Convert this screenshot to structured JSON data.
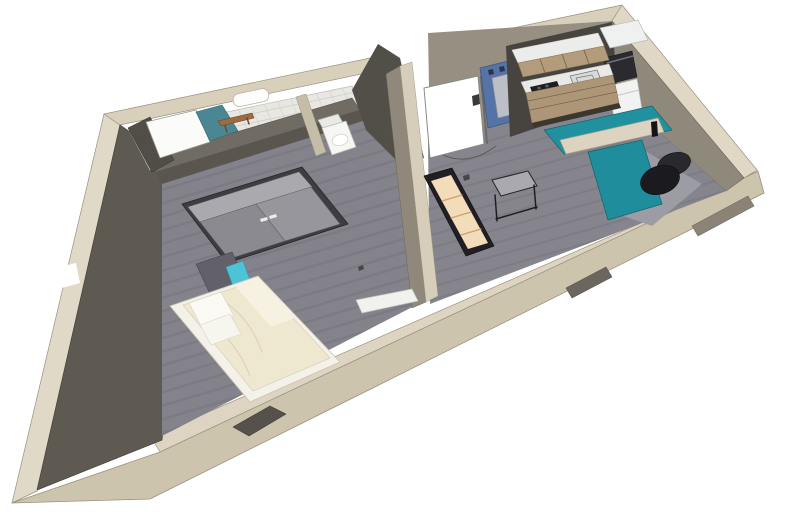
{
  "meta": {
    "description": "3D cutaway render of a studio apartment floor plan",
    "image_type": "3d-floorplan-render",
    "background": "#FFFFFF"
  },
  "palette": {
    "shell_light": "#DDD5C2",
    "shell_face": "#CDC4AD",
    "wall_dark": "#5E5951",
    "wall_taupe": "#8F897B",
    "floor_wood": "#84838B",
    "tile_white": "#E8E7E2",
    "accent_teal_desk": "#21919F",
    "accent_teal_shower": "#4B8793",
    "accent_cyan_drawer": "#4EC3D8",
    "accent_blue_panel": "#5673A7",
    "cabinet_tan": "#B39C7B",
    "bed_cream": "#EFE8D1"
  },
  "rooms": [
    {
      "name": "bathroom",
      "items": [
        "shower",
        "glass-panel",
        "towel-radiator",
        "wood-bench"
      ]
    },
    {
      "name": "wc",
      "items": [
        "toilet"
      ]
    },
    {
      "name": "bedroom",
      "items": [
        "wardrobe",
        "bed",
        "nightstand",
        "wall-radiator"
      ]
    },
    {
      "name": "entry-hall",
      "items": [
        "entrance-door",
        "blue-coat-panel-with-mirror",
        "light-switch"
      ]
    },
    {
      "name": "kitchen",
      "items": [
        "upper-cabinets",
        "counter",
        "cooktop",
        "sink",
        "lower-cabinets",
        "oven",
        "fridge"
      ]
    },
    {
      "name": "living-area",
      "items": [
        "l-shaped-desk",
        "desk-divider",
        "office-chair",
        "bookcase",
        "side-table"
      ]
    }
  ],
  "scene": {
    "width": 800,
    "height": 524,
    "shapes": [
      {
        "t": "p",
        "n": "south-wall-outer-face",
        "pts": "758,171 764,193 150,499 12,503 160,452",
        "f": "#CDC4AD",
        "s": "#9A9280",
        "w": 0.8
      },
      {
        "t": "p",
        "n": "south-wall-top-band",
        "pts": "758,171 744,178 151,437 160,452",
        "f": "#DDD5C2",
        "s": "#9A9280",
        "w": 0.7
      },
      {
        "t": "p",
        "n": "west-wall-top-strip",
        "pts": "104,114 120,125 37,491 12,503",
        "f": "#E1D9C7",
        "s": "#9A9280",
        "w": 0.7
      },
      {
        "t": "p",
        "n": "west-wall-window-notch",
        "pts": "55,268 76,263 80,283 58,289",
        "f": "#FFFFFF"
      },
      {
        "t": "p",
        "n": "north-wall-top-band",
        "pts": "104,114 622,5 612,21 120,125",
        "f": "#D8D0BB",
        "s": "#9A9280",
        "w": 0.7
      },
      {
        "t": "p",
        "n": "east-wall-top-band",
        "pts": "622,5 757,170 744,178 612,21",
        "f": "#E0D8C5",
        "s": "#9A9280",
        "w": 0.7
      },
      {
        "t": "p",
        "n": "entrance-door-opening",
        "pts": "374,41 434,29 440,58 382,71",
        "f": "#FFFFFF"
      },
      {
        "t": "p",
        "n": "west-wall-interior-face",
        "pts": "120,125 196,178 162,440 37,490",
        "f": "#5E5951",
        "s": "#474339",
        "w": 0.7
      },
      {
        "t": "p",
        "n": "east-wall-interior-face",
        "pts": "612,21 744,178 726,191 618,96",
        "f": "#8F897B",
        "s": "#6E685C",
        "w": 0.6
      },
      {
        "t": "p",
        "n": "north-wall-interior-hall",
        "pts": "428,33 612,21 618,96 430,140",
        "f": "#968F82"
      },
      {
        "t": "p",
        "n": "bathroom-tile-floor",
        "pts": "130,132 352,86 374,146 150,170",
        "f": "#E8E7E2",
        "s": "#BBBAB4",
        "w": 0.7
      },
      {
        "t": "h",
        "n": "tile-grout-horizontal",
        "clip": "130,132 352,86 374,146 150,170",
        "x1": 126,
        "y1": 131,
        "x2": 380,
        "y2": 78,
        "dx": 0,
        "dy": 9,
        "cnt": 7,
        "s": "#CFCEC8",
        "w": 0.8
      },
      {
        "t": "h",
        "n": "tile-grout-vertical",
        "clip": "130,132 352,86 374,146 150,170",
        "x1": 134,
        "y1": 130,
        "x2": 156,
        "y2": 182,
        "dx": 13,
        "dy": -2.7,
        "cnt": 18,
        "s": "#D3D2CC",
        "w": 0.7
      },
      {
        "t": "p",
        "n": "bedroom-floor",
        "pts": "162,180 360,118 404,104 426,300 162,436",
        "f": "#84838B"
      },
      {
        "t": "h",
        "n": "bedroom-floor-planks",
        "clip": "162,180 360,118 404,104 426,300 162,436",
        "x1": 150,
        "y1": 180,
        "x2": 430,
        "y2": 96,
        "dx": 0,
        "dy": 13.5,
        "cnt": 20,
        "s": "#73727A",
        "w": 2.4,
        "o": 0.5
      },
      {
        "t": "p",
        "n": "living-floor",
        "pts": "428,140 618,96 726,191 430,304",
        "f": "#86858D"
      },
      {
        "t": "h",
        "n": "living-floor-planks",
        "clip": "428,140 618,96 726,191 430,304",
        "x1": 420,
        "y1": 160,
        "x2": 740,
        "y2": 70,
        "dx": 0,
        "dy": 13,
        "cnt": 19,
        "s": "#75747C",
        "w": 2.2,
        "o": 0.5
      },
      {
        "t": "p",
        "n": "living-floor-light-patch",
        "pts": "606,210 640,148 702,184 652,226",
        "f": "#9B9CA4"
      },
      {
        "t": "p",
        "n": "window-slot-right",
        "pts": "692,226 748,196 754,206 698,236",
        "f": "#8A8376",
        "s": "#6E6A5E",
        "w": 0.6
      },
      {
        "t": "p",
        "n": "window-slot-middle",
        "pts": "566,288 606,267 612,277 572,298",
        "f": "#6B675F",
        "s": "#56534B",
        "w": 0.6
      },
      {
        "t": "p",
        "n": "window-slot-bedroom",
        "pts": "233,427 270,406 286,414 249,436",
        "f": "#56524B",
        "s": "#403D36",
        "w": 0.6
      },
      {
        "t": "p",
        "n": "bath-partition-top",
        "pts": "148,158 352,98 360,110 156,172",
        "f": "#706C63",
        "s": "#54504A",
        "w": 0.6
      },
      {
        "t": "p",
        "n": "bath-partition-face",
        "pts": "156,172 360,110 366,120 162,184",
        "f": "#5A564F"
      },
      {
        "t": "p",
        "n": "wc-divider-wall",
        "pts": "296,97 306,94 326,152 316,156",
        "f": "#C6BDA8",
        "s": "#9A9280",
        "w": 0.5
      },
      {
        "t": "p",
        "n": "wc-east-wall",
        "pts": "352,90 378,44 400,58 424,158 402,166 366,130",
        "f": "#524E48"
      },
      {
        "t": "p",
        "n": "hall-partition-west-face",
        "pts": "386,74 400,66 426,302 412,308",
        "f": "#8F887B",
        "s": "#6E685C",
        "w": 0.5
      },
      {
        "t": "p",
        "n": "hall-partition-top",
        "pts": "400,66 412,62 438,296 426,302",
        "f": "#D6CEBA",
        "s": "#A49B84",
        "w": 0.5
      },
      {
        "t": "p",
        "n": "shower-wall",
        "pts": "128,128 150,117 174,160 152,172",
        "f": "#514D47",
        "s": "#3C3934",
        "w": 0.6
      },
      {
        "t": "p",
        "n": "shower-glass-panel",
        "pts": "146,122 196,110 210,142 160,158",
        "f": "#FBFBF9",
        "s": "#9A9A94",
        "w": 0.8
      },
      {
        "t": "p",
        "n": "shower-teal-floor",
        "pts": "196,112 222,105 238,131 210,141",
        "f": "#4B8793",
        "s": "#35646E",
        "w": 0.6
      },
      {
        "t": "r",
        "n": "towel-radiator",
        "x": 0,
        "y": 0,
        "wd": 36,
        "ht": 13,
        "rx": 6,
        "f": "#FDFDFC",
        "s": "#B5B4AE",
        "w": 0.8,
        "tr": "translate(232,95) rotate(-12)"
      },
      {
        "t": "p",
        "n": "wood-bench",
        "pts": "218,121 252,113 254,118 221,126",
        "f": "#9C6B3F",
        "s": "#6B4426",
        "w": 0.6
      },
      {
        "t": "l",
        "n": "bench-leg-left",
        "x1": 225,
        "y1": 126,
        "x2": 227,
        "y2": 132,
        "s": "#6B4426",
        "w": 1.4
      },
      {
        "t": "l",
        "n": "bench-leg-right",
        "x1": 247,
        "y1": 118,
        "x2": 249,
        "y2": 124,
        "s": "#6B4426",
        "w": 1.4
      },
      {
        "t": "p",
        "n": "toilet-tank",
        "pts": "318,120 338,114 346,128 326,134",
        "f": "#E9E9E5",
        "s": "#B0B0AA",
        "w": 0.7
      },
      {
        "t": "p",
        "n": "toilet-body",
        "pts": "322,128 346,121 356,147 332,155",
        "f": "#F6F6F3",
        "s": "#B9B8B2",
        "w": 0.8
      },
      {
        "t": "e",
        "n": "toilet-seat",
        "cx": 340,
        "cy": 140,
        "rx": 8,
        "ry": 5.5,
        "f": "#FFFFFF",
        "s": "#CCCCC6",
        "w": 0.7,
        "tr": "rotate(-14 340 140)"
      },
      {
        "t": "p",
        "n": "wardrobe-frame",
        "pts": "182,204 302,167 348,224 227,263",
        "f": "#3E3D42",
        "s": "#26252A",
        "w": 0.8
      },
      {
        "t": "p",
        "n": "wardrobe-top-face",
        "pts": "188,207 299,172 312,187 200,222",
        "f": "#A9A9AE",
        "s": "#7F7F85",
        "w": 0.5
      },
      {
        "t": "p",
        "n": "wardrobe-door-left",
        "pts": "200,222 256,204 285,241 229,259",
        "f": "#8A8A90",
        "s": "#5C5C62",
        "w": 0.6
      },
      {
        "t": "p",
        "n": "wardrobe-door-right",
        "pts": "256,204 311,187 340,224 285,241",
        "f": "#96969C",
        "s": "#5C5C62",
        "w": 0.6
      },
      {
        "t": "p",
        "n": "wardrobe-handle-left",
        "pts": "260,219 267,217 268,220 261,222",
        "f": "#ECECEA"
      },
      {
        "t": "p",
        "n": "wardrobe-handle-right",
        "pts": "269,216 276,214 277,217 270,219",
        "f": "#ECECEA"
      },
      {
        "t": "p",
        "n": "nightstand-body",
        "pts": "196,264 232,252 246,282 210,294",
        "f": "#62616A",
        "s": "#47464E",
        "w": 0.6
      },
      {
        "t": "p",
        "n": "nightstand-cyan-drawer",
        "pts": "226,267 243,261 251,283 234,289",
        "f": "#4EC3D8",
        "s": "#2E97AB",
        "w": 0.6
      },
      {
        "t": "p",
        "n": "bed-frame",
        "pts": "170,306 258,276 340,362 250,402",
        "f": "#F3F1E8",
        "s": "#C9C6B8",
        "w": 0.9
      },
      {
        "t": "p",
        "n": "bed-duvet",
        "pts": "183,305 258,280 330,358 253,391",
        "f": "#EFE8D1",
        "s": "#D8D0B4",
        "w": 0.7
      },
      {
        "t": "p",
        "n": "duvet-fold",
        "pts": "236,287 259,279 294,318 271,327",
        "f": "#F6F1E0"
      },
      {
        "t": "d",
        "n": "duvet-crease-1",
        "d": "M222,300 Q250,318 262,352",
        "f": "none",
        "s": "#DCD4BA",
        "w": 1.2
      },
      {
        "t": "d",
        "n": "duvet-crease-2",
        "d": "M206,320 Q236,340 250,376",
        "f": "none",
        "s": "#DCD4BA",
        "w": 1.2
      },
      {
        "t": "p",
        "n": "pillow-1",
        "pts": "189,303 221,292 234,316 202,328",
        "f": "#FAF9F4",
        "s": "#D8D5C8",
        "w": 0.7
      },
      {
        "t": "p",
        "n": "pillow-2",
        "pts": "200,325 230,314 241,334 211,345",
        "f": "#F6F5EE",
        "s": "#D8D5C8",
        "w": 0.6
      },
      {
        "t": "p",
        "n": "bedroom-wall-radiator",
        "pts": "356,300 412,289 418,301 362,313",
        "f": "#F1F1ED",
        "s": "#C2C2BC",
        "w": 0.7
      },
      {
        "t": "d",
        "n": "door-swing-arc",
        "d": "M 434,150 Q 464,170 496,146",
        "f": "none",
        "s": "#5A5A5A",
        "w": 1
      },
      {
        "t": "p",
        "n": "entrance-door-leaf",
        "pts": "424,88 478,76 484,144 430,158",
        "f": "#FFFFFF",
        "s": "#8A8A86",
        "w": 1
      },
      {
        "t": "l",
        "n": "entrance-door-edge",
        "x1": 481,
        "y1": 77,
        "x2": 487,
        "y2": 143,
        "s": "#6A6A66",
        "w": 2
      },
      {
        "t": "p",
        "n": "blue-coat-panel",
        "pts": "480,68 524,57 532,116 488,128",
        "f": "#5673A7",
        "s": "#3D5680",
        "w": 0.8
      },
      {
        "t": "p",
        "n": "coat-panel-mirror",
        "pts": "492,78 512,73 518,113 498,118",
        "f": "#BCC0C6",
        "s": "#8B8F96",
        "w": 0.7
      },
      {
        "t": "p",
        "n": "coat-hook-1",
        "pts": "488,70 493,69 494,74 489,75",
        "f": "#2A3642"
      },
      {
        "t": "p",
        "n": "coat-hook-2",
        "pts": "499,67 504,66 505,71 500,72",
        "f": "#2A3642"
      },
      {
        "t": "p",
        "n": "coat-hook-3",
        "pts": "510,64 515,63 516,68 511,69",
        "f": "#2A3642"
      },
      {
        "t": "p",
        "n": "light-switch",
        "pts": "472,96 479,94 480,104 473,106",
        "f": "#3A3A3E"
      },
      {
        "t": "p",
        "n": "kitchen-backsplash",
        "pts": "506,46 612,22 618,100 510,137",
        "f": "#474440"
      },
      {
        "t": "p",
        "n": "tall-unit-top",
        "pts": "600,28 638,20 648,40 610,48",
        "f": "#EFF1F0",
        "s": "#B9BCBA",
        "w": 0.7
      },
      {
        "t": "p",
        "n": "oven",
        "pts": "604,58 632,51 637,77 609,84",
        "f": "#2B2B2F",
        "s": "#151518",
        "w": 0.6
      },
      {
        "t": "l",
        "n": "oven-handle",
        "x1": 607,
        "y1": 63,
        "x2": 633,
        "y2": 56,
        "s": "#70707A",
        "w": 1.5
      },
      {
        "t": "p",
        "n": "fridge",
        "pts": "609,86 637,79 642,110 614,118",
        "f": "#F1F2F1",
        "s": "#C5C8C6",
        "w": 0.7
      },
      {
        "t": "l",
        "n": "fridge-seam",
        "x1": 611,
        "y1": 97,
        "x2": 639,
        "y2": 90,
        "s": "#C5C8C6",
        "w": 1
      },
      {
        "t": "p",
        "n": "upper-cabinets-top",
        "pts": "512,50 598,33 604,46 518,63",
        "f": "#ECEDEA",
        "s": "#C5C6C2",
        "w": 0.6
      },
      {
        "t": "p",
        "n": "upper-cabinets-front",
        "pts": "518,63 604,46 609,60 523,77",
        "f": "#B39C7B",
        "s": "#8A7455",
        "w": 0.6
      },
      {
        "t": "l",
        "n": "upper-cabinet-seam-1",
        "x1": 540,
        "y1": 59,
        "x2": 545,
        "y2": 73,
        "s": "#7A6548",
        "w": 0.9
      },
      {
        "t": "l",
        "n": "upper-cabinet-seam-2",
        "x1": 562,
        "y1": 54,
        "x2": 567,
        "y2": 68,
        "s": "#7A6548",
        "w": 0.9
      },
      {
        "t": "l",
        "n": "upper-cabinet-seam-3",
        "x1": 584,
        "y1": 50,
        "x2": 589,
        "y2": 64,
        "s": "#7A6548",
        "w": 0.9
      },
      {
        "t": "p",
        "n": "kitchen-counter",
        "pts": "521,82 609,64 613,75 526,93",
        "f": "#E9EAE7",
        "s": "#B9BAB6",
        "w": 0.6
      },
      {
        "t": "p",
        "n": "cooktop",
        "pts": "530,87 557,81 561,91 534,97",
        "f": "#1E1E22"
      },
      {
        "t": "e",
        "n": "burner-1",
        "cx": 539,
        "cy": 88,
        "rx": 2,
        "ry": 1.5,
        "f": "#55555B"
      },
      {
        "t": "e",
        "n": "burner-2",
        "cx": 547,
        "cy": 86,
        "rx": 2,
        "ry": 1.5,
        "f": "#55555B"
      },
      {
        "t": "e",
        "n": "burner-3",
        "cx": 543,
        "cy": 93,
        "rx": 2,
        "ry": 1.5,
        "f": "#55555B"
      },
      {
        "t": "e",
        "n": "burner-4",
        "cx": 551,
        "cy": 91,
        "rx": 2,
        "ry": 1.5,
        "f": "#55555B"
      },
      {
        "t": "p",
        "n": "kitchen-sink",
        "pts": "570,76 597,70 601,80 574,86",
        "f": "#D8DAD9",
        "s": "#75777A",
        "w": 0.8
      },
      {
        "t": "p",
        "n": "sink-basin",
        "pts": "576,78 592,75 595,81 579,84",
        "f": "none",
        "s": "#75777A",
        "w": 0.7
      },
      {
        "t": "p",
        "n": "lower-cabinets-front",
        "pts": "526,93 613,75 619,103 532,123",
        "f": "#AD9678",
        "s": "#8A7455",
        "w": 0.6
      },
      {
        "t": "l",
        "n": "drawer-seam-1",
        "x1": 528,
        "y1": 101,
        "x2": 615,
        "y2": 83,
        "s": "#7A6548",
        "w": 0.8
      },
      {
        "t": "l",
        "n": "drawer-seam-2",
        "x1": 530,
        "y1": 110,
        "x2": 617,
        "y2": 92,
        "s": "#7A6548",
        "w": 0.8
      },
      {
        "t": "p",
        "n": "cabinet-kickboard",
        "pts": "532,123 619,103 621,108 534,128",
        "f": "#3B362E"
      },
      {
        "t": "p",
        "n": "bookcase-frame",
        "pts": "424,176 452,168 494,246 466,256",
        "f": "#211F24",
        "s": "#121015",
        "w": 0.7
      },
      {
        "t": "p",
        "n": "bookcase-front",
        "pts": "431,181 451,175 488,243 468,249",
        "f": "#F2DCBA"
      },
      {
        "t": "l",
        "n": "bookcase-shelf-1",
        "x1": 442,
        "y1": 201,
        "x2": 462,
        "y2": 195,
        "s": "#C9A26E",
        "w": 1.2
      },
      {
        "t": "l",
        "n": "bookcase-shelf-2",
        "x1": 451,
        "y1": 218,
        "x2": 471,
        "y2": 212,
        "s": "#C9A26E",
        "w": 1.2
      },
      {
        "t": "l",
        "n": "bookcase-shelf-3",
        "x1": 461,
        "y1": 235,
        "x2": 481,
        "y2": 229,
        "s": "#C9A26E",
        "w": 1.2
      },
      {
        "t": "p",
        "n": "side-table-top",
        "pts": "492,180 528,171 537,186 501,196",
        "f": "#A9A9AF",
        "s": "#2A2A2E",
        "w": 1.1
      },
      {
        "t": "l",
        "n": "side-table-leg-1",
        "x1": 495,
        "y1": 195,
        "x2": 497,
        "y2": 221,
        "s": "#1E1E22",
        "w": 1.5
      },
      {
        "t": "l",
        "n": "side-table-leg-2",
        "x1": 534,
        "y1": 185,
        "x2": 536,
        "y2": 209,
        "s": "#1E1E22",
        "w": 1.5
      },
      {
        "t": "l",
        "n": "side-table-shelf",
        "x1": 496,
        "y1": 219,
        "x2": 537,
        "y2": 207,
        "s": "#1E1E22",
        "w": 1.5
      },
      {
        "t": "p",
        "n": "desk-back-surface",
        "pts": "544,130 652,106 672,130 564,154",
        "f": "#21919F",
        "s": "#12646E",
        "w": 0.7
      },
      {
        "t": "p",
        "n": "desk-divider-shelf",
        "pts": "560,140 658,118 664,132 566,154",
        "f": "#DCD4C0",
        "s": "#A9A08A",
        "w": 0.7
      },
      {
        "t": "p",
        "n": "desk-return-surface",
        "pts": "588,152 642,140 662,204 608,220",
        "f": "#1F8D9B",
        "s": "#12646E",
        "w": 0.7
      },
      {
        "t": "p",
        "n": "desk-bottle",
        "pts": "651,122 657,121 658,136 652,137",
        "f": "#141418"
      },
      {
        "t": "e",
        "n": "office-chair-backrest",
        "cx": 674,
        "cy": 164,
        "rx": 17,
        "ry": 11,
        "f": "#28282D",
        "s": "#101014",
        "w": 0.6,
        "tr": "rotate(-18 674 164)"
      },
      {
        "t": "e",
        "n": "office-chair-seat",
        "cx": 660,
        "cy": 180,
        "rx": 20,
        "ry": 14,
        "f": "#1B1B1F",
        "s": "#0C0C10",
        "w": 0.6,
        "tr": "rotate(-18 660 180)"
      },
      {
        "t": "p",
        "n": "floor-speck-1",
        "pts": "463,176 469,174 470,179 464,181",
        "f": "#46454B"
      },
      {
        "t": "p",
        "n": "floor-speck-2",
        "pts": "358,267 363,265 364,269 359,271",
        "f": "#46454B"
      }
    ]
  }
}
